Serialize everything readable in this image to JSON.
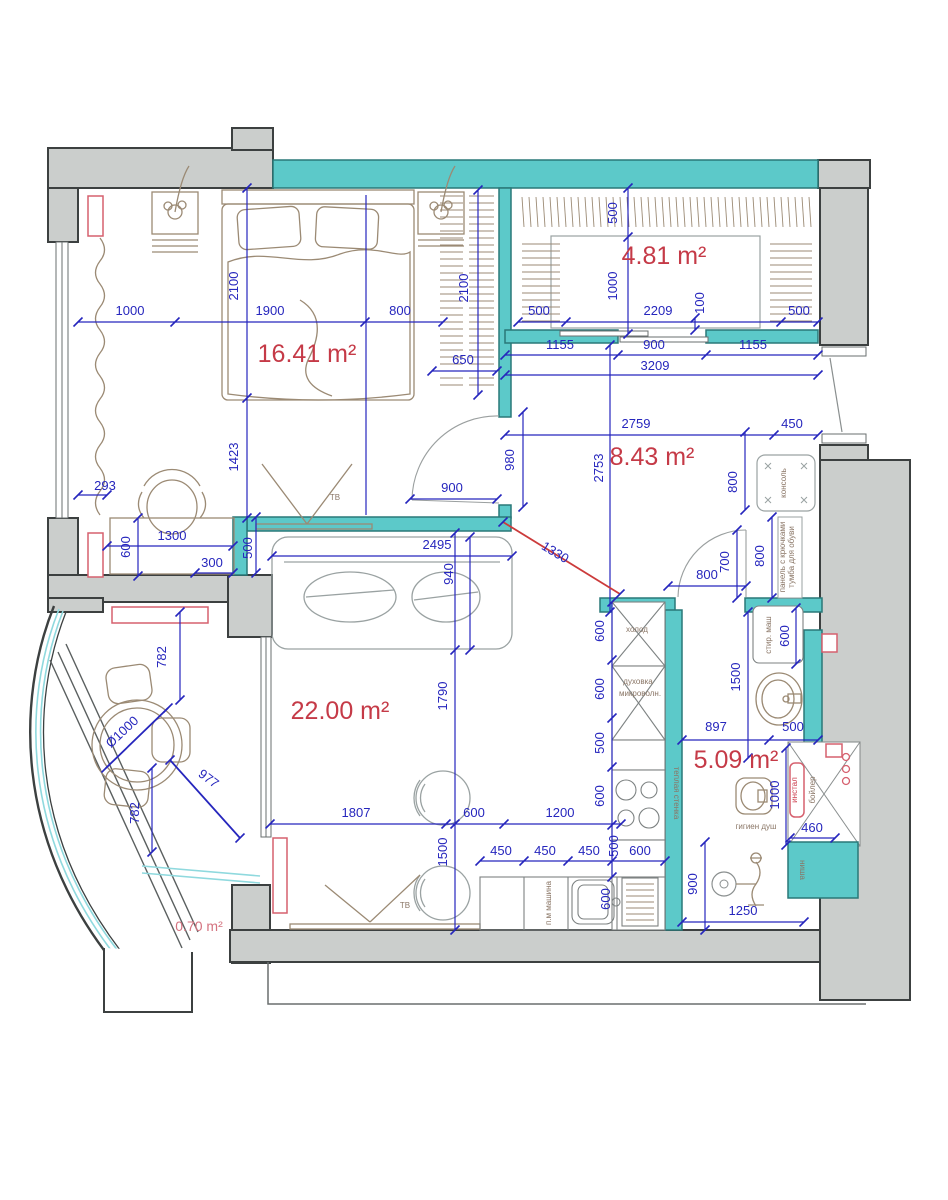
{
  "document": {
    "type": "apartment floor plan",
    "units": "mm"
  },
  "colors": {
    "wall_gray": "#cbcecc",
    "wall_teal": "#5cc9c9",
    "dimension_blue": "#2626bd",
    "area_label_red": "#c53a47",
    "area_label_pink": "#d4727f",
    "furniture_brown": "#9b8a74",
    "fixture_red": "#d6606e",
    "glazing_cyan": "#8fd9de"
  },
  "room_labels": [
    {
      "text": "16.41 m²",
      "x": 307,
      "y": 362
    },
    {
      "text": "4.81 m²",
      "x": 664,
      "y": 264
    },
    {
      "text": "8.43 m²",
      "x": 652,
      "y": 465
    },
    {
      "text": "22.00 m²",
      "x": 340,
      "y": 719
    },
    {
      "text": "5.09 m²",
      "x": 736,
      "y": 768
    },
    {
      "text": "0.70 m²",
      "x": 199,
      "y": 931,
      "small": true
    }
  ],
  "dimensions": [
    {
      "text": "1000",
      "x": 130,
      "y": 315
    },
    {
      "text": "1900",
      "x": 270,
      "y": 315
    },
    {
      "text": "800",
      "x": 400,
      "y": 315
    },
    {
      "text": "2100",
      "x": 238,
      "y": 286,
      "rot": -90
    },
    {
      "text": "2100",
      "x": 468,
      "y": 288,
      "rot": -90
    },
    {
      "text": "650",
      "x": 463,
      "y": 364
    },
    {
      "text": "1423",
      "x": 238,
      "y": 457,
      "rot": -90
    },
    {
      "text": "293",
      "x": 105,
      "y": 490
    },
    {
      "text": "1300",
      "x": 172,
      "y": 540
    },
    {
      "text": "600",
      "x": 130,
      "y": 547,
      "rot": -90
    },
    {
      "text": "300",
      "x": 212,
      "y": 567
    },
    {
      "text": "500",
      "x": 252,
      "y": 548,
      "rot": -90
    },
    {
      "text": "900",
      "x": 452,
      "y": 492
    },
    {
      "text": "980",
      "x": 514,
      "y": 460,
      "rot": -90
    },
    {
      "text": "500",
      "x": 617,
      "y": 213,
      "rot": -90
    },
    {
      "text": "1000",
      "x": 617,
      "y": 286,
      "rot": -90
    },
    {
      "text": "500",
      "x": 539,
      "y": 315
    },
    {
      "text": "2209",
      "x": 658,
      "y": 315
    },
    {
      "text": "500",
      "x": 799,
      "y": 315
    },
    {
      "text": "100",
      "x": 704,
      "y": 303,
      "rot": -90
    },
    {
      "text": "1155",
      "x": 560,
      "y": 349
    },
    {
      "text": "900",
      "x": 654,
      "y": 349
    },
    {
      "text": "1155",
      "x": 753,
      "y": 349
    },
    {
      "text": "3209",
      "x": 655,
      "y": 370
    },
    {
      "text": "2759",
      "x": 636,
      "y": 428
    },
    {
      "text": "450",
      "x": 792,
      "y": 428
    },
    {
      "text": "2753",
      "x": 603,
      "y": 468,
      "rot": -90
    },
    {
      "text": "800",
      "x": 737,
      "y": 482,
      "rot": -90
    },
    {
      "text": "800",
      "x": 707,
      "y": 579
    },
    {
      "text": "700",
      "x": 729,
      "y": 562,
      "rot": -90
    },
    {
      "text": "800",
      "x": 764,
      "y": 556,
      "rot": -90
    },
    {
      "text": "1330",
      "x": 553,
      "y": 556,
      "rot": 31
    },
    {
      "text": "2495",
      "x": 437,
      "y": 549
    },
    {
      "text": "940",
      "x": 453,
      "y": 574,
      "rot": -90
    },
    {
      "text": "1790",
      "x": 447,
      "y": 696,
      "rot": -90
    },
    {
      "text": "1807",
      "x": 356,
      "y": 817
    },
    {
      "text": "600",
      "x": 474,
      "y": 817
    },
    {
      "text": "1200",
      "x": 560,
      "y": 817
    },
    {
      "text": "1500",
      "x": 447,
      "y": 852,
      "rot": -90
    },
    {
      "text": "450",
      "x": 501,
      "y": 855
    },
    {
      "text": "450",
      "x": 545,
      "y": 855
    },
    {
      "text": "450",
      "x": 589,
      "y": 855
    },
    {
      "text": "500",
      "x": 618,
      "y": 846,
      "rot": -90
    },
    {
      "text": "600",
      "x": 640,
      "y": 855
    },
    {
      "text": "600",
      "x": 604,
      "y": 631,
      "rot": -90
    },
    {
      "text": "600",
      "x": 604,
      "y": 689,
      "rot": -90
    },
    {
      "text": "500",
      "x": 604,
      "y": 743,
      "rot": -90
    },
    {
      "text": "600",
      "x": 604,
      "y": 796,
      "rot": -90
    },
    {
      "text": "600",
      "x": 610,
      "y": 899,
      "rot": -90
    },
    {
      "text": "897",
      "x": 716,
      "y": 731
    },
    {
      "text": "500",
      "x": 793,
      "y": 731
    },
    {
      "text": "1500",
      "x": 740,
      "y": 677,
      "rot": -90
    },
    {
      "text": "600",
      "x": 789,
      "y": 636,
      "rot": -90
    },
    {
      "text": "1000",
      "x": 779,
      "y": 795,
      "rot": -90
    },
    {
      "text": "460",
      "x": 812,
      "y": 832
    },
    {
      "text": "900",
      "x": 697,
      "y": 884,
      "rot": -90
    },
    {
      "text": "1250",
      "x": 743,
      "y": 915
    },
    {
      "text": "782",
      "x": 166,
      "y": 657,
      "rot": -90
    },
    {
      "text": "Ø1000",
      "x": 125,
      "y": 735,
      "rot": -43
    },
    {
      "text": "977",
      "x": 206,
      "y": 782,
      "rot": 37
    },
    {
      "text": "782",
      "x": 139,
      "y": 813,
      "rot": -90
    }
  ],
  "annotations": [
    {
      "text": "ТВ",
      "x": 335,
      "y": 500
    },
    {
      "text": "ТВ",
      "x": 405,
      "y": 908
    },
    {
      "text": "холод",
      "x": 637,
      "y": 632
    },
    {
      "text": "духовка",
      "x": 638,
      "y": 684
    },
    {
      "text": "микроволн.",
      "x": 640,
      "y": 696
    },
    {
      "text": "теплая стенка",
      "x": 674,
      "y": 793,
      "rot": 90
    },
    {
      "text": "стир. маш",
      "x": 771,
      "y": 635,
      "rot": -90
    },
    {
      "text": "консоль",
      "x": 786,
      "y": 483,
      "rot": -90
    },
    {
      "text": "панель с крючками",
      "x": 785,
      "y": 557,
      "rot": -90,
      "size": 6
    },
    {
      "text": "тумба для обуви",
      "x": 794,
      "y": 557,
      "rot": -90,
      "size": 6
    },
    {
      "text": "гигиен душ",
      "x": 756,
      "y": 829
    },
    {
      "text": "инстал",
      "x": 797,
      "y": 790,
      "rot": -90,
      "red": true
    },
    {
      "text": "бойлер",
      "x": 815,
      "y": 790,
      "rot": -90
    },
    {
      "text": "ниша",
      "x": 800,
      "y": 870,
      "rot": 90
    },
    {
      "text": "п.м машина",
      "x": 551,
      "y": 903,
      "rot": -90
    }
  ]
}
